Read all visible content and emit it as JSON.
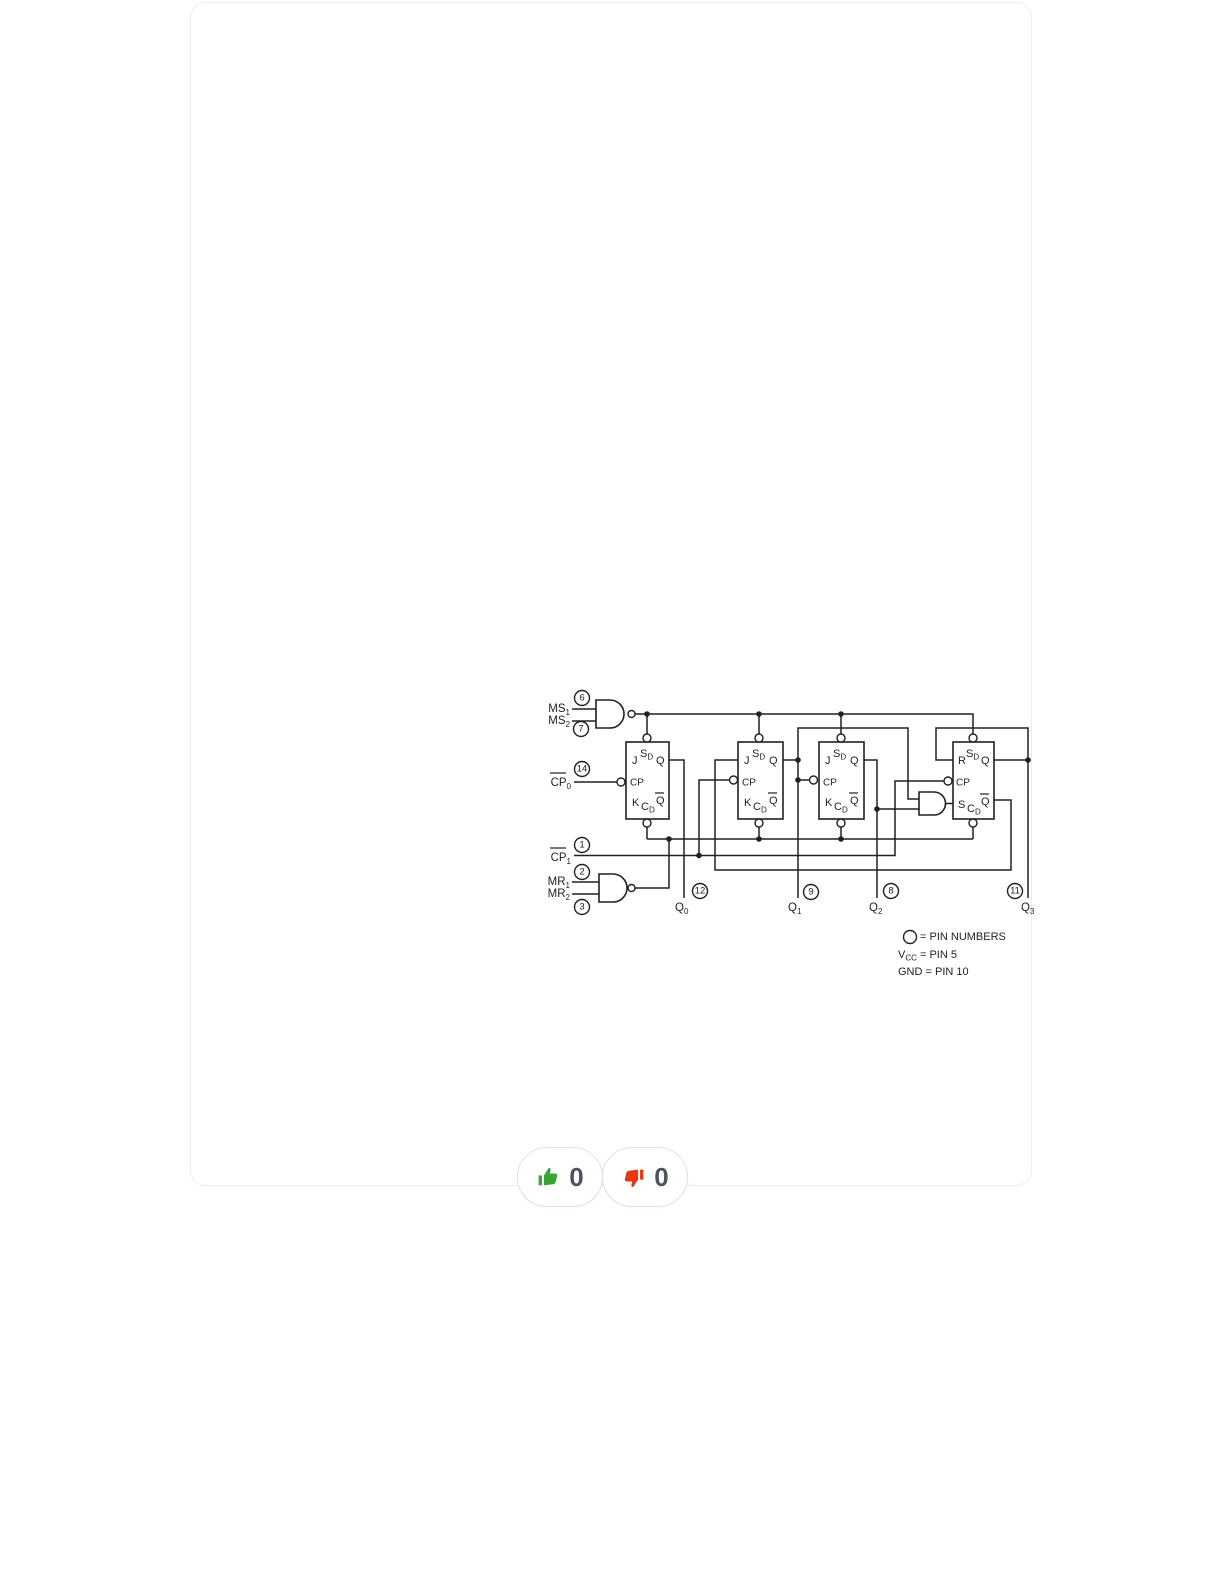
{
  "card": {
    "border_color": "#e9edf0",
    "background": "#ffffff"
  },
  "diagram": {
    "ink": "#212121",
    "inputs": {
      "ms1": {
        "base": "MS",
        "sub": "1",
        "pin": "6"
      },
      "ms2": {
        "base": "MS",
        "sub": "2",
        "pin": "7"
      },
      "cp0": {
        "base": "CP",
        "sub": "0",
        "pin": "14"
      },
      "cp1": {
        "base": "CP",
        "sub": "1",
        "pin": "1"
      },
      "mr1": {
        "base": "MR",
        "sub": "1",
        "pin": "2"
      },
      "mr2": {
        "base": "MR",
        "sub": "2",
        "pin": "3"
      }
    },
    "outputs": {
      "q0": {
        "base": "Q",
        "sub": "0",
        "pin": "12"
      },
      "q1": {
        "base": "Q",
        "sub": "1",
        "pin": "9"
      },
      "q2": {
        "base": "Q",
        "sub": "2",
        "pin": "8"
      },
      "q3": {
        "base": "Q",
        "sub": "3",
        "pin": "11"
      }
    },
    "ff_labels": {
      "j": "J",
      "k": "K",
      "r": "R",
      "s": "S",
      "cp": "CP",
      "q": "Q",
      "qbar": "Q",
      "set_base": "S",
      "clear_base": "C",
      "sub_d": "D"
    },
    "legend": {
      "pin_note": "= PIN NUMBERS",
      "vcc_base": "V",
      "vcc_sub": "CC",
      "vcc_eq": " = PIN 5",
      "gnd": "GND = PIN 10"
    }
  },
  "vote": {
    "up_count": "0",
    "down_count": "0",
    "up_color": "#3ba336",
    "down_color": "#e8360e",
    "count_color": "#4a545f"
  }
}
